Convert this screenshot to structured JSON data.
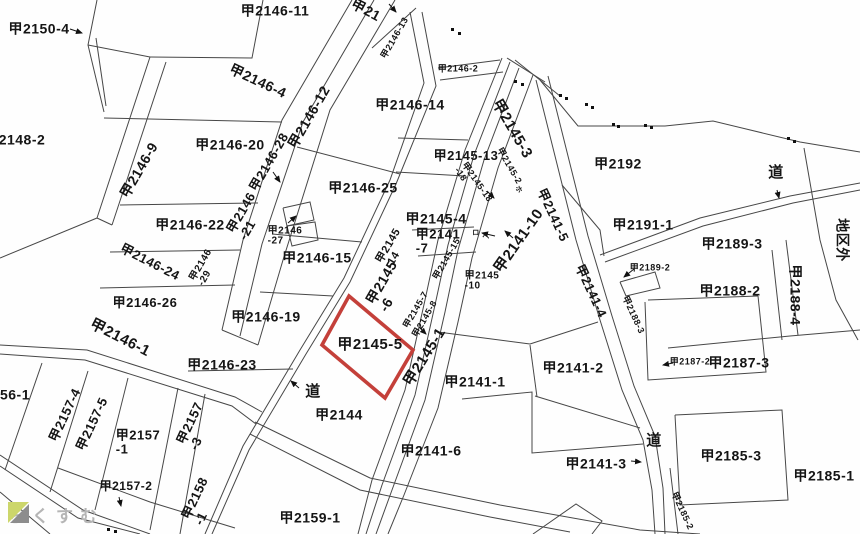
{
  "map": {
    "highlight_color": "#c4403a",
    "line_color": "#474747",
    "highlighted_parcel": "甲2145-5",
    "labels": [
      {
        "lines": [
          "甲2150-4"
        ],
        "x": 39,
        "y": 29,
        "rot": 0,
        "size": 14
      },
      {
        "lines": [
          "2148-2"
        ],
        "x": 22,
        "y": 140,
        "rot": 0,
        "size": 14
      },
      {
        "lines": [
          "甲2146-11"
        ],
        "x": 275,
        "y": 11,
        "rot": 0,
        "size": 14
      },
      {
        "lines": [
          "甲21"
        ],
        "x": 366,
        "y": 10,
        "rot": 28,
        "size": 14
      },
      {
        "lines": [
          "甲2146-13"
        ],
        "x": 395,
        "y": 38,
        "rot": -60,
        "size": 9
      },
      {
        "lines": [
          "甲2146-2"
        ],
        "x": 458,
        "y": 69,
        "rot": 0,
        "size": 9
      },
      {
        "lines": [
          "甲2146-4"
        ],
        "x": 258,
        "y": 81,
        "rot": 25,
        "size": 14
      },
      {
        "lines": [
          "甲2146-12"
        ],
        "x": 309,
        "y": 117,
        "rot": -60,
        "size": 14
      },
      {
        "lines": [
          "甲2146-14"
        ],
        "x": 410,
        "y": 105,
        "rot": 0,
        "size": 14
      },
      {
        "lines": [
          "甲2146-9"
        ],
        "x": 139,
        "y": 170,
        "rot": -60,
        "size": 14
      },
      {
        "lines": [
          "甲2146-20"
        ],
        "x": 230,
        "y": 145,
        "rot": 0,
        "size": 14
      },
      {
        "lines": [
          "甲2145-13"
        ],
        "x": 466,
        "y": 156,
        "rot": 0,
        "size": 13
      },
      {
        "lines": [
          "甲2145-3"
        ],
        "x": 512,
        "y": 129,
        "rot": 60,
        "size": 15
      },
      {
        "lines": [
          "甲2145-2"
        ],
        "x": 509,
        "y": 166,
        "rot": 60,
        "size": 9
      },
      {
        "lines": [
          "甲2145-18",
          "-18"
        ],
        "x": 473,
        "y": 185,
        "rot": 55,
        "size": 9
      },
      {
        "lines": [
          "甲2146-25"
        ],
        "x": 363,
        "y": 188,
        "rot": 0,
        "size": 14
      },
      {
        "lines": [
          "甲2146-28"
        ],
        "x": 269,
        "y": 162,
        "rot": -60,
        "size": 13
      },
      {
        "lines": [
          "甲2146",
          "-21"
        ],
        "x": 247,
        "y": 216,
        "rot": -60,
        "size": 13
      },
      {
        "lines": [
          "甲2146-22"
        ],
        "x": 190,
        "y": 225,
        "rot": 0,
        "size": 14
      },
      {
        "lines": [
          "甲2146",
          "-27"
        ],
        "x": 285,
        "y": 237,
        "rot": 0,
        "size": 10
      },
      {
        "lines": [
          "甲2146-15"
        ],
        "x": 317,
        "y": 258,
        "rot": 0,
        "size": 14
      },
      {
        "lines": [
          "甲2146-24"
        ],
        "x": 150,
        "y": 262,
        "rot": 27,
        "size": 13
      },
      {
        "lines": [
          "甲2146",
          "-29"
        ],
        "x": 206,
        "y": 268,
        "rot": -60,
        "size": 10
      },
      {
        "lines": [
          "甲2145-4"
        ],
        "x": 436,
        "y": 219,
        "rot": 0,
        "size": 14
      },
      {
        "lines": [
          "甲2141",
          "-7"
        ],
        "x": 438,
        "y": 241,
        "rot": 0,
        "size": 13
      },
      {
        "lines": [
          "甲2145",
          "-14"
        ],
        "x": 394,
        "y": 249,
        "rot": -60,
        "size": 11
      },
      {
        "lines": [
          "甲2145-15"
        ],
        "x": 447,
        "y": 259,
        "rot": -60,
        "size": 9
      },
      {
        "lines": [
          "甲2141-10"
        ],
        "x": 519,
        "y": 241,
        "rot": -55,
        "size": 15
      },
      {
        "lines": [
          "甲2141-5"
        ],
        "x": 553,
        "y": 215,
        "rot": 65,
        "size": 13
      },
      {
        "lines": [
          "甲2146-26"
        ],
        "x": 145,
        "y": 303,
        "rot": 0,
        "size": 13
      },
      {
        "lines": [
          "甲2146-19"
        ],
        "x": 266,
        "y": 317,
        "rot": 0,
        "size": 14
      },
      {
        "lines": [
          "甲2145",
          "-6"
        ],
        "x": 388,
        "y": 286,
        "rot": -60,
        "size": 14
      },
      {
        "lines": [
          "甲2145",
          "-10"
        ],
        "x": 482,
        "y": 282,
        "rot": 0,
        "size": 10
      },
      {
        "lines": [
          "甲2145-7"
        ],
        "x": 416,
        "y": 310,
        "rot": -60,
        "size": 9
      },
      {
        "lines": [
          "甲2145-8"
        ],
        "x": 425,
        "y": 319,
        "rot": -60,
        "size": 9
      },
      {
        "lines": [
          "ロ"
        ],
        "x": 476,
        "y": 233,
        "rot": 0,
        "size": 7
      },
      {
        "lines": [
          "ヘ"
        ],
        "x": 486,
        "y": 237,
        "rot": 0,
        "size": 7
      },
      {
        "lines": [
          "ホ"
        ],
        "x": 518,
        "y": 190,
        "rot": 60,
        "size": 7
      },
      {
        "lines": [
          "甲2192"
        ],
        "x": 618,
        "y": 164,
        "rot": 0,
        "size": 14
      },
      {
        "lines": [
          "道"
        ],
        "x": 776,
        "y": 173,
        "rot": 0,
        "size": 15
      },
      {
        "lines": [
          "甲2191-1"
        ],
        "x": 643,
        "y": 225,
        "rot": 0,
        "size": 14
      },
      {
        "lines": [
          "甲2189-3"
        ],
        "x": 732,
        "y": 244,
        "rot": 0,
        "size": 14
      },
      {
        "lines": [
          "甲2189-2"
        ],
        "x": 650,
        "y": 268,
        "rot": 0,
        "size": 9
      },
      {
        "lines": [
          "甲2188-2"
        ],
        "x": 730,
        "y": 291,
        "rot": 0,
        "size": 14
      },
      {
        "lines": [
          "甲2188-4"
        ],
        "x": 795,
        "y": 295,
        "rot": 90,
        "size": 14
      },
      {
        "lines": [
          "地区外"
        ],
        "x": 842,
        "y": 240,
        "rot": 90,
        "size": 14
      },
      {
        "lines": [
          "甲2141-4"
        ],
        "x": 591,
        "y": 291,
        "rot": 65,
        "size": 13
      },
      {
        "lines": [
          "甲2188-3"
        ],
        "x": 633,
        "y": 315,
        "rot": 65,
        "size": 9
      },
      {
        "lines": [
          "甲2146-1"
        ],
        "x": 120,
        "y": 338,
        "rot": 27,
        "size": 15
      },
      {
        "lines": [
          "甲2146-23"
        ],
        "x": 222,
        "y": 365,
        "rot": 0,
        "size": 14
      },
      {
        "lines": [
          "甲2145-5"
        ],
        "x": 370,
        "y": 345,
        "rot": 0,
        "size": 15
      },
      {
        "lines": [
          "甲2145-1"
        ],
        "x": 425,
        "y": 357,
        "rot": -58,
        "size": 15
      },
      {
        "lines": [
          "甲2141-1"
        ],
        "x": 475,
        "y": 382,
        "rot": 0,
        "size": 14
      },
      {
        "lines": [
          "甲2141-2"
        ],
        "x": 573,
        "y": 368,
        "rot": 0,
        "size": 14
      },
      {
        "lines": [
          "甲2187-2"
        ],
        "x": 690,
        "y": 362,
        "rot": 0,
        "size": 9
      },
      {
        "lines": [
          "甲2187-3"
        ],
        "x": 739,
        "y": 363,
        "rot": 0,
        "size": 14
      },
      {
        "lines": [
          "56-1"
        ],
        "x": 15,
        "y": 395,
        "rot": 0,
        "size": 14
      },
      {
        "lines": [
          "甲2157-4"
        ],
        "x": 65,
        "y": 415,
        "rot": -65,
        "size": 13
      },
      {
        "lines": [
          "甲2157-5"
        ],
        "x": 92,
        "y": 424,
        "rot": -65,
        "size": 13
      },
      {
        "lines": [
          "道"
        ],
        "x": 313,
        "y": 392,
        "rot": 0,
        "size": 15
      },
      {
        "lines": [
          "甲2144"
        ],
        "x": 339,
        "y": 415,
        "rot": 0,
        "size": 14
      },
      {
        "lines": [
          "甲2141-6"
        ],
        "x": 431,
        "y": 451,
        "rot": 0,
        "size": 14
      },
      {
        "lines": [
          "甲2157",
          "-1"
        ],
        "x": 138,
        "y": 442,
        "rot": 0,
        "size": 13
      },
      {
        "lines": [
          "甲2157",
          "-3"
        ],
        "x": 196,
        "y": 426,
        "rot": -65,
        "size": 13
      },
      {
        "lines": [
          "甲2141-3"
        ],
        "x": 596,
        "y": 464,
        "rot": 0,
        "size": 14
      },
      {
        "lines": [
          "道"
        ],
        "x": 654,
        "y": 441,
        "rot": 0,
        "size": 15
      },
      {
        "lines": [
          "甲2185-3"
        ],
        "x": 731,
        "y": 456,
        "rot": 0,
        "size": 14
      },
      {
        "lines": [
          "甲2185-1"
        ],
        "x": 824,
        "y": 476,
        "rot": 0,
        "size": 14
      },
      {
        "lines": [
          "甲2185-2"
        ],
        "x": 682,
        "y": 511,
        "rot": 65,
        "size": 9
      },
      {
        "lines": [
          "甲2157-2"
        ],
        "x": 126,
        "y": 486,
        "rot": 0,
        "size": 12
      },
      {
        "lines": [
          "甲2158",
          "-1"
        ],
        "x": 201,
        "y": 501,
        "rot": -65,
        "size": 13
      },
      {
        "lines": [
          "甲2159-1"
        ],
        "x": 310,
        "y": 518,
        "rot": 0,
        "size": 14
      }
    ]
  },
  "watermark": {
    "text": "らくすむ",
    "text_color": "#b5b5b5",
    "logo_green": "#ccd66b",
    "logo_gray": "#8d8d8d"
  }
}
